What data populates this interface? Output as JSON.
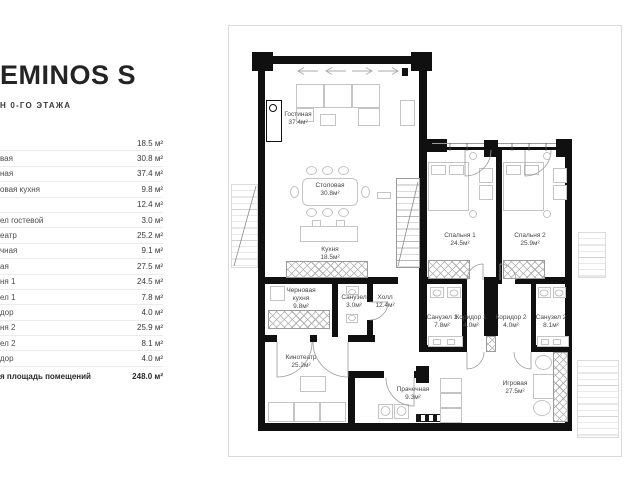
{
  "header": {
    "title": "EMINOS S",
    "subtitle": "Н 0-ГО ЭТАЖА"
  },
  "legend": {
    "rows": [
      {
        "label": "",
        "value": "18.5 м²"
      },
      {
        "label": "вая",
        "value": "30.8 м²"
      },
      {
        "label": "ная",
        "value": "37.4 м²"
      },
      {
        "label": "овая кухня",
        "value": "9.8 м²"
      },
      {
        "label": "",
        "value": "12.4 м²"
      },
      {
        "label": "ел гостевой",
        "value": "3.0 м²"
      },
      {
        "label": "еатр",
        "value": "25.2 м²"
      },
      {
        "label": "чная",
        "value": "9.1 м²"
      },
      {
        "label": "ая",
        "value": "27.5 м²"
      },
      {
        "label": "ня 1",
        "value": "24.5 м²"
      },
      {
        "label": "ел 1",
        "value": "7.8 м²"
      },
      {
        "label": "дор",
        "value": "4.0 м²"
      },
      {
        "label": "ня 2",
        "value": "25.9 м²"
      },
      {
        "label": "ел 2",
        "value": "8.1 м²"
      },
      {
        "label": "дор",
        "value": "4.0 м²"
      }
    ],
    "total": {
      "label": "я площадь помещений",
      "value": "248.0 м²"
    }
  },
  "plan": {
    "rooms": [
      {
        "name": "Гостиная",
        "area": "37.4м²"
      },
      {
        "name": "Столовая",
        "area": "30.8м²"
      },
      {
        "name": "Кухня",
        "area": "18.5м²"
      },
      {
        "name": "Черновая кухня",
        "area": "9.8м²"
      },
      {
        "name": "Санузел",
        "area": "3.0м²"
      },
      {
        "name": "Холл",
        "area": "12.4м²"
      },
      {
        "name": "Кинотеатр",
        "area": "25.2м²"
      },
      {
        "name": "Прачечная",
        "area": "9.3м²"
      },
      {
        "name": "Спальня 1",
        "area": "24.5м²"
      },
      {
        "name": "Спальня 2",
        "area": "25.9м²"
      },
      {
        "name": "Санузел 1",
        "area": "7.8м²"
      },
      {
        "name": "Коридор 1",
        "area": "4.0м²"
      },
      {
        "name": "Коридор 2",
        "area": "4.0м²"
      },
      {
        "name": "Санузел 2",
        "area": "8.1м²"
      },
      {
        "name": "Игровая",
        "area": "27.5м²"
      }
    ]
  },
  "colors": {
    "wall": "#101010",
    "furniture_outline": "#c4c4c4",
    "divider": "#ececec",
    "text": "#3a3a3a"
  }
}
